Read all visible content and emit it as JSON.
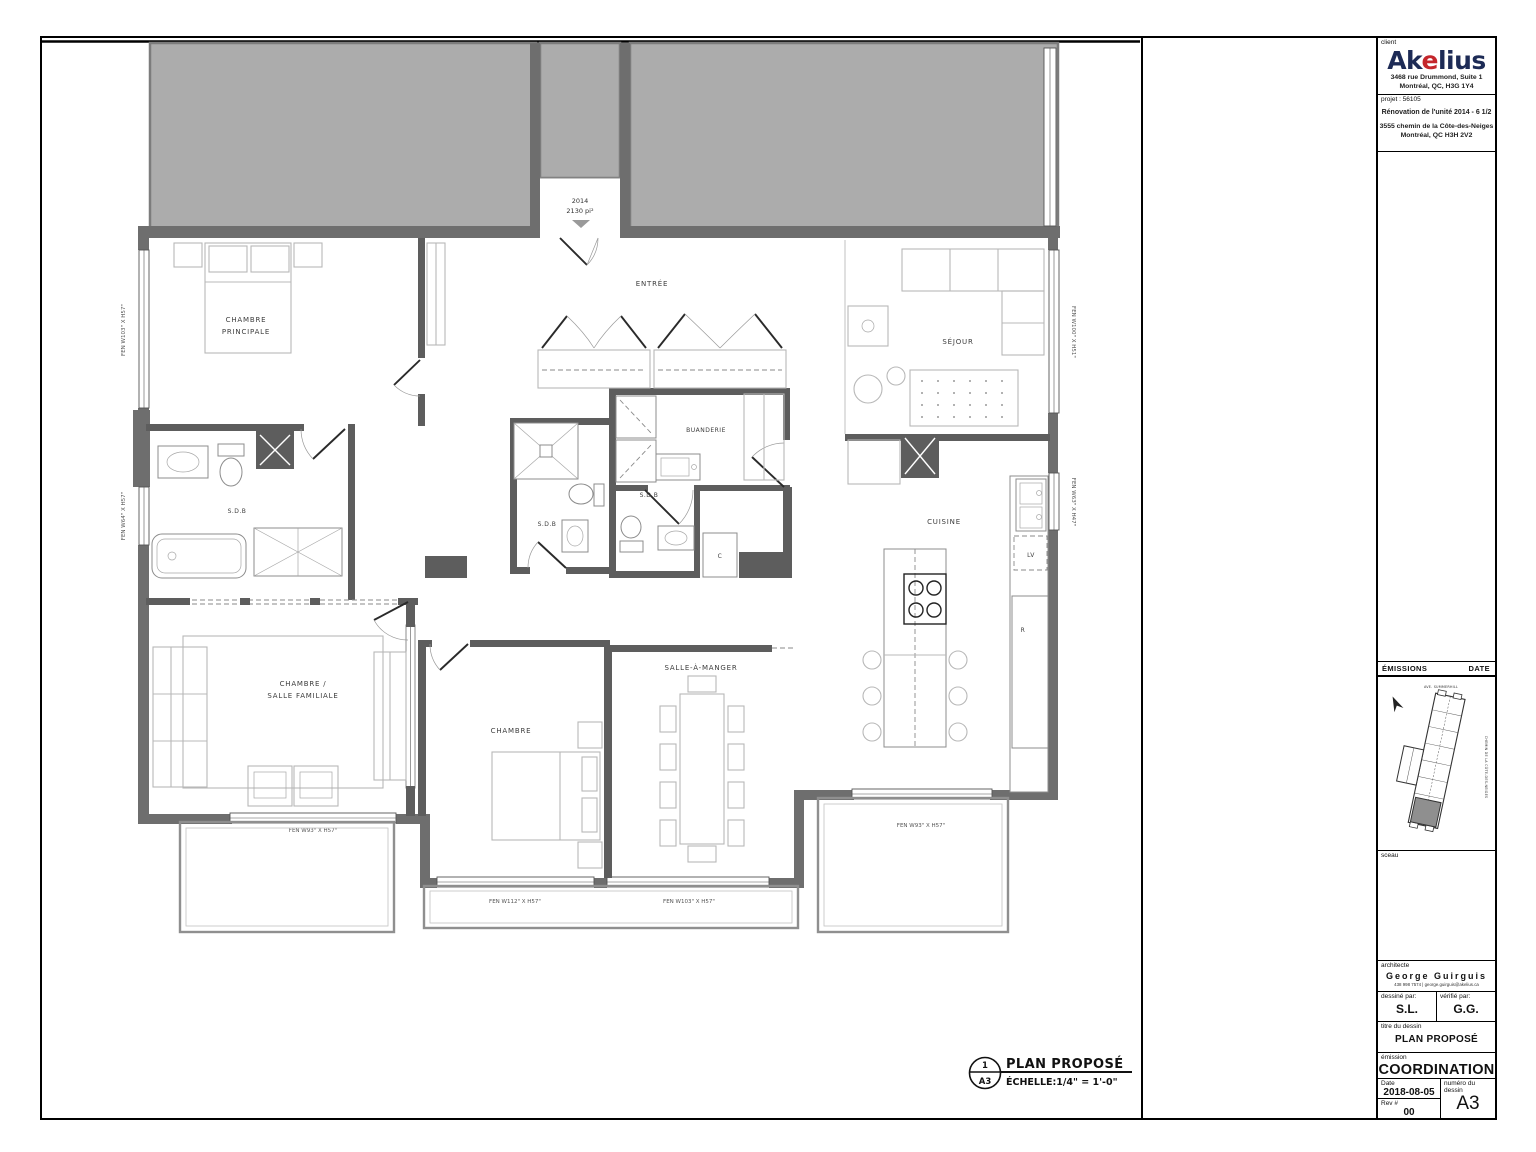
{
  "sheet": {
    "caption": {
      "detail_number": "1",
      "sheet_ref": "A3",
      "title": "PLAN PROPOSÉ",
      "scale": "ÉCHELLE:1/4\" = 1'-0\""
    }
  },
  "title_block": {
    "client_label": "client",
    "logo": {
      "pre": "Ak",
      "accent": "e",
      "post": "lius"
    },
    "client_address1": "3468 rue Drummond, Suite 1",
    "client_address2": "Montréal, QC, H3G 1Y4",
    "project_label": "projet : 56105",
    "project_title": "Rénovation de l'unité 2014 - 6 1/2",
    "project_address1": "3555 chemin de la Côte-des-Neiges",
    "project_address2": "Montréal, QC H3H 2V2",
    "emissions_label": "ÉMISSIONS",
    "date_col_label": "DATE",
    "keyplan": {
      "street_top": "AVE. SUMMERHILL",
      "street_right": "CHEMIN DE LA CÔTE-DES-NEIGES"
    },
    "sceau_label": "sceau",
    "architecte_label": "architecte",
    "architect_name": "George Guirguis",
    "architect_contact": "438 998 7574 | george.guirguis@akelius.ca",
    "drawn_label": "dessiné par:",
    "drawn_value": "S.L.",
    "checked_label": "vérifié par:",
    "checked_value": "G.G.",
    "title_label": "titre du dessin",
    "title_value": "PLAN PROPOSÉ",
    "emission_label": "émission",
    "emission_value": "COORDINATION",
    "date_label": "Date",
    "date_value": "2018-08-05",
    "number_label": "numéro du dessin",
    "number_value": "A3",
    "rev_label": "Rev #",
    "rev_value": "00"
  },
  "plan": {
    "unit_number": "2014",
    "unit_area": "2130 pi²",
    "rooms": {
      "chambre_principale_l1": "CHAMBRE",
      "chambre_principale_l2": "PRINCIPALE",
      "entree": "ENTRÉE",
      "sejour": "SÉJOUR",
      "sdb_master": "S.D.B",
      "sdb_shower": "S.D.B",
      "sdb_center": "S.D.B",
      "buanderie": "BUANDERIE",
      "cuisine": "CUISINE",
      "salle_familiale_l1": "CHAMBRE /",
      "salle_familiale_l2": "SALLE FAMILIALE",
      "chambre": "CHAMBRE",
      "salle_a_manger": "SALLE-À-MANGER"
    },
    "appliances": {
      "dishwasher": "LV",
      "fridge": "R",
      "closet": "C"
    },
    "windows": {
      "left_top": "FEN W103\" X H57\"",
      "left_bottom": "FEN W64\" X H57\"",
      "right_top": "FEN W100\" X H51\"",
      "right_mid": "FEN W63\" X H47\"",
      "bottom_left": "FEN W93\" X H57\"",
      "bottom_center_left": "FEN W112\" X H57\"",
      "bottom_center_right": "FEN W103\" X H57\"",
      "bottom_right": "FEN W93\" X H57\""
    }
  }
}
